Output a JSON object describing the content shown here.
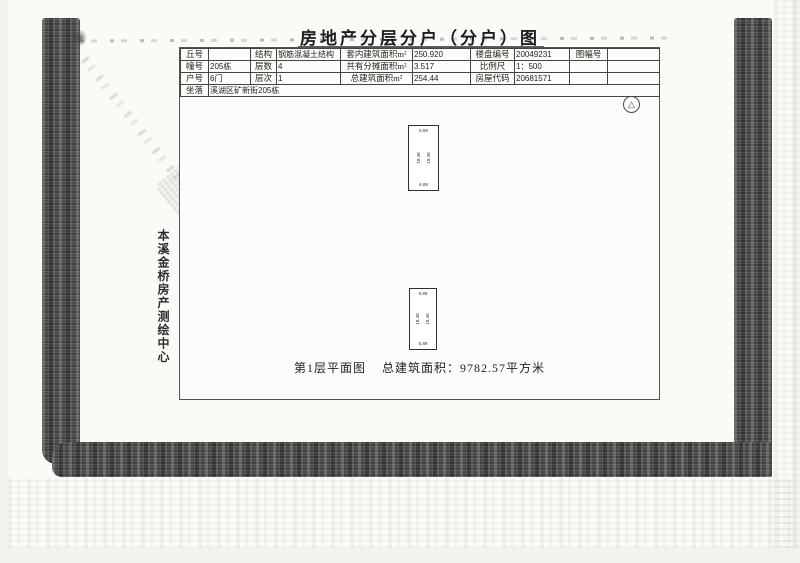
{
  "document": {
    "title": "房地产分层分户（分户）图"
  },
  "table": {
    "rows": [
      {
        "c0": "丘号",
        "c1": "",
        "c2": "结构",
        "c3": "钢筋混凝土结构",
        "c4": "套内建筑面积m²",
        "c5": "250.920",
        "c6": "楼盘编号",
        "c7": "20049231",
        "c8": "图幅号",
        "c9": ""
      },
      {
        "c0": "幢号",
        "c1": "205栋",
        "c2": "层数",
        "c3": "4",
        "c4": "共有分摊面积m²",
        "c5": "3.517",
        "c6": "比例尺",
        "c7": "1：500",
        "c8": "",
        "c9": ""
      },
      {
        "c0": "户号",
        "c1": "6门",
        "c2": "层次",
        "c3": "1",
        "c4": "总建筑面积m²",
        "c5": "254.44",
        "c6": "房屋代码",
        "c7": "20681571",
        "c8": "",
        "c9": ""
      }
    ],
    "site_label": "坐落",
    "site_value": "溪湖区矿新街205栋"
  },
  "plan": {
    "caption_left": "第1层平面图",
    "caption_right": "总建筑面积：9782.57平方米",
    "unit_top": {
      "top": "6.89",
      "left": "18.48",
      "right": "18.48",
      "bottom": "6.89"
    },
    "unit_bottom": {
      "top": "6.89",
      "left": "18.48",
      "right": "18.48",
      "bottom": "6.89"
    }
  },
  "agency_label": "本溪金桥房产测绘中心",
  "icons": {
    "compass_logo": "△"
  },
  "colors": {
    "frame_dark": "#4d4b49",
    "paper": "#fbfaf7",
    "stamp_green": "#768a78"
  }
}
